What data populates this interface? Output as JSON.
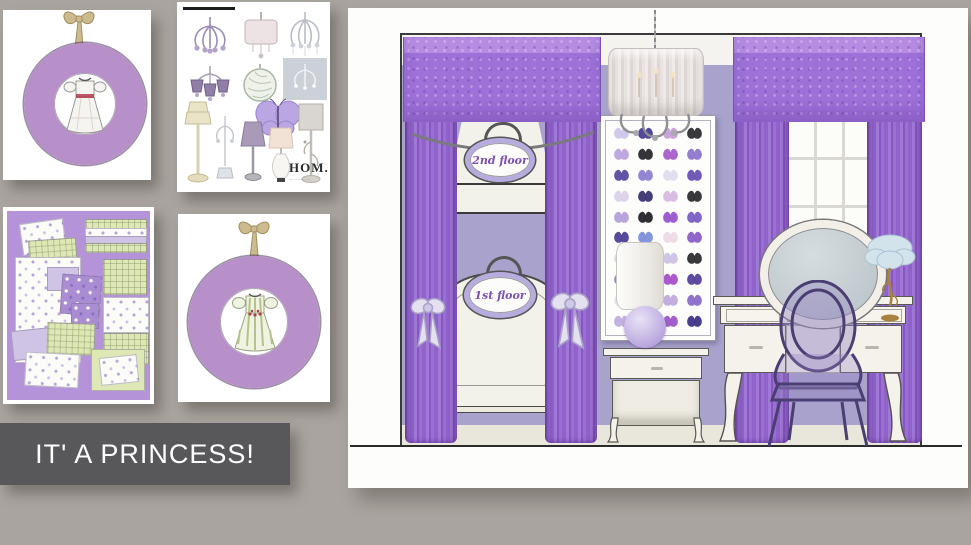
{
  "canvas": {
    "background": "#a9a49f"
  },
  "banner": {
    "text": "IT' A PRINCESS!",
    "bg": "#58575a",
    "text_color": "#ffffff"
  },
  "cards": {
    "wreath1": {
      "ring_color": "#b78fc9",
      "dress": "white-plaid-dress-red-smocking",
      "ribbon_color": "#c9b98f"
    },
    "catalog": {
      "logo": "HOM.",
      "items": [
        "purple-crystal-chandelier",
        "drum-shade-pendant",
        "crystal-chandelier",
        "mini-shaded-chandelier",
        "crystal-sphere-pendant",
        "framed-chandelier-print",
        "lavender-butterfly-decor",
        "cream-tiered-lamp",
        "crystal-candelabra-lamp",
        "purple-shade-lamp",
        "pink-gourd-lamp",
        "gray-shade-branch-lamp"
      ]
    },
    "bedding": {
      "bg": "#b493d8",
      "items": [
        "floral-pillow",
        "green-plaid-pillow",
        "floral-duvet-set",
        "purple-floral-shams",
        "striped-sheet-stack",
        "folded-plaid-stack",
        "floral-sheet-stack",
        "lavender-pillow",
        "white-floral-pillow",
        "green-sheet-set"
      ]
    },
    "wreath2": {
      "ring_color": "#b78fc9",
      "dress": "green-striped-dress",
      "ribbon_color": "#c9b98f"
    }
  },
  "room": {
    "wall_color": "#a8a2cd",
    "crown_color": "#f4f3ef",
    "floor_color": "#e9e7db",
    "valance_color": "#9d72d8",
    "curtain_color": "#9468cc",
    "plaque_top": "2nd floor",
    "plaque_bottom": "1st floor",
    "elements": [
      "drum-chandelier",
      "bunk-bed-alcove",
      "butterfly-specimen-panel",
      "cylinder-lamp",
      "nightstand",
      "window",
      "vanity-desk",
      "oval-vanity-mirror",
      "ghost-chair",
      "tutu-lamp"
    ],
    "butterfly_colors": [
      [
        "#cfc6e8",
        "#4b3f93",
        "#c79fd8",
        "#2e2e33"
      ],
      [
        "#b9a4dc",
        "#2a2a2e",
        "#a65ec8",
        "#8d76cc"
      ],
      [
        "#5b4aa0",
        "#8f7fd0",
        "#e2dcee",
        "#6a52b4"
      ],
      [
        "#d9d2ea",
        "#3c3472",
        "#d8b9e0",
        "#2e2e33"
      ],
      [
        "#b4a0d8",
        "#26262a",
        "#9a55cc",
        "#7a5fc2"
      ],
      [
        "#4f3f96",
        "#7d8fd8",
        "#ecd9e6",
        "#8a5fc6"
      ],
      [
        "#ddd6ec",
        "#3a3080",
        "#cfc2e4",
        "#2e2e33"
      ],
      [
        "#9a7fd0",
        "#8fa0dc",
        "#a850c8",
        "#55429c"
      ],
      [
        "#e6e0f0",
        "#413884",
        "#c0aade",
        "#8a6cc8"
      ],
      [
        "#bfaede",
        "#7a52c0",
        "#9d55c8",
        "#3f3588"
      ]
    ]
  }
}
